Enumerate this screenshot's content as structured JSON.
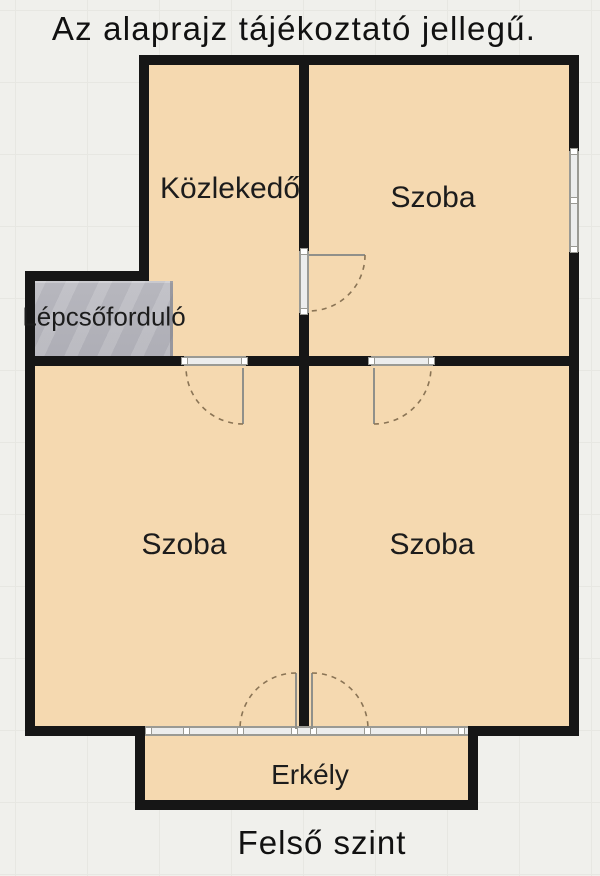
{
  "title": "Az alaprajz tájékoztató jellegű.",
  "footer": "Felső szint",
  "rooms": {
    "hallway": {
      "label": "Közlekedő"
    },
    "room_top_right": {
      "label": "Szoba"
    },
    "stair_landing": {
      "label": "Lépcsőforduló"
    },
    "room_bottom_left": {
      "label": "Szoba"
    },
    "room_bottom_right": {
      "label": "Szoba"
    },
    "balcony": {
      "label": "Erkély"
    }
  },
  "floor_plan": {
    "type": "floor-plan",
    "level": "upper",
    "features": {
      "doors": [
        "hallway-to-top-right-room",
        "hallway-to-bottom-left-room",
        "top-right-room-to-bottom-right-room",
        "bottom-left-room-to-balcony",
        "bottom-right-room-to-balcony"
      ],
      "windows": [
        "right-wall-window-top-right-room",
        "balcony-glass-front"
      ],
      "stairs": "stair-landing-hatched-area"
    },
    "colors": {
      "background": "#f0f0ec",
      "grid_line": "#e7e7e2",
      "room_fill": "#f5d9b0",
      "wall": "#161616",
      "stairs_fill": "#b3b3ba",
      "jamb_line": "#9a9a94",
      "jamb_fill": "#eceded",
      "door_leaf": "#90908a",
      "door_arc": "#8a7455",
      "text": "#1c1c1c"
    }
  }
}
